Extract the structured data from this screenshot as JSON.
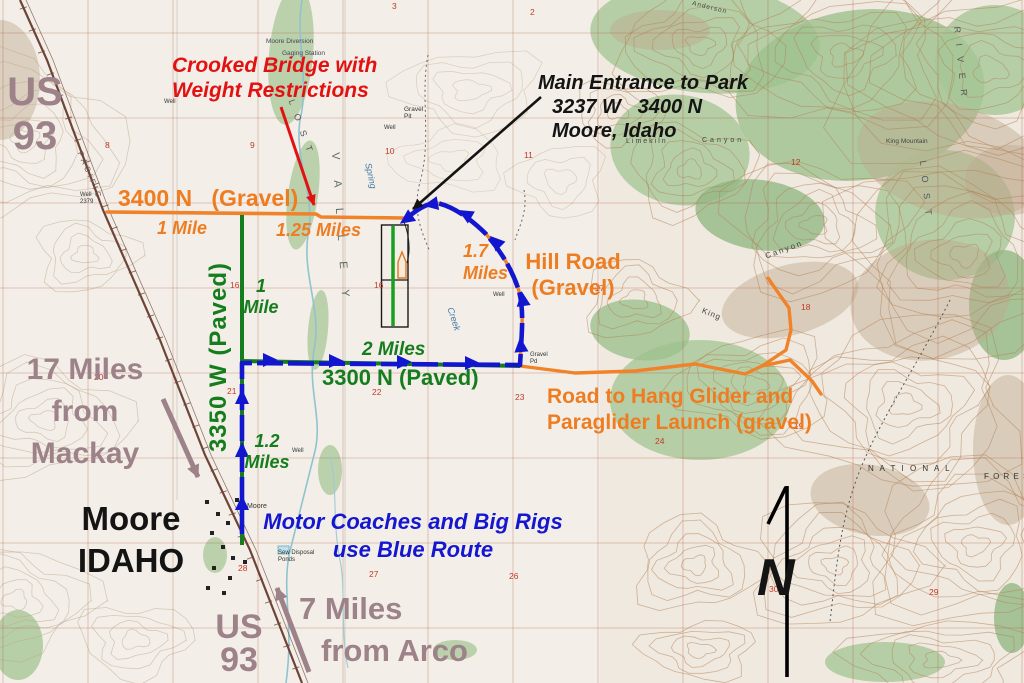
{
  "map": {
    "title": "Driving directions map to park near Moore, Idaho",
    "colors": {
      "road_gravel_orange": "#ee7d22",
      "road_paved_green": "#157d1d",
      "blue_route": "#1216cf",
      "warning_red": "#e31212",
      "distance_mauve": "#9d8289",
      "ink_black": "#141414"
    },
    "labels": {
      "us93_top": {
        "line1": "US",
        "line2": "93"
      },
      "crooked_bridge": {
        "text": "Crooked Bridge with\nWeight Restrictions"
      },
      "main_entrance": {
        "line1": "Main Entrance to Park",
        "line2": "3237 W   3400 N",
        "line3": "Moore, Idaho"
      },
      "road_3400n": {
        "text": "3400 N   (Gravel)"
      },
      "mile_1_orange": {
        "text": "1 Mile"
      },
      "miles_1_25": {
        "text": "1.25 Miles"
      },
      "miles_1_7": {
        "text": "1.7\nMiles"
      },
      "hill_road": {
        "text": "Hill Road\n(Gravel)"
      },
      "road_3350w": {
        "text": "3350 W (Paved)"
      },
      "mile_1_green": {
        "text": "1\nMile"
      },
      "miles_2": {
        "text": "2 Miles"
      },
      "road_3300n": {
        "text": "3300 N (Paved)"
      },
      "hang_glider_road": {
        "text": "Road to Hang Glider and\nParaglider Launch (gravel)"
      },
      "mackay": {
        "text": "17 Miles\nfrom\nMackay"
      },
      "moore_town": {
        "text": "Moore\nIDAHO"
      },
      "miles_1_2": {
        "text": "1.2\nMiles"
      },
      "motor_coaches": {
        "text": "Motor Coaches and Big Rigs\nuse Blue Route"
      },
      "us93_bottom": {
        "line1": "US",
        "line2": "93"
      },
      "arco": {
        "line1": "7 Miles",
        "line2": "from Arco"
      },
      "compass_n": {
        "text": "N"
      }
    },
    "landmarks": [
      {
        "text": "PACIFIC",
        "x": 84,
        "y": 150,
        "s": 8,
        "c": "#6b5a50",
        "r": 67,
        "ls": 3
      },
      {
        "text": "Moore Diversion",
        "x": 266,
        "y": 38,
        "s": 6.5,
        "c": "#445"
      },
      {
        "text": "Gaging Station",
        "x": 282,
        "y": 50,
        "s": 6.5,
        "c": "#445"
      },
      {
        "text": "V A L L E Y",
        "x": 341,
        "y": 152,
        "s": 11,
        "c": "#5c6b5c",
        "r": 86,
        "ls": 9
      },
      {
        "text": "Spring",
        "x": 373,
        "y": 162,
        "s": 9,
        "c": "#4179a3",
        "r": 78,
        "i": 1
      },
      {
        "text": "Creek",
        "x": 455,
        "y": 306,
        "s": 9,
        "c": "#4179a3",
        "r": 72,
        "i": 1
      },
      {
        "text": "L O S T",
        "x": 296,
        "y": 98,
        "s": 9,
        "c": "#555",
        "r": 70,
        "ls": 4
      },
      {
        "text": "Limekiln",
        "x": 626,
        "y": 138,
        "s": 7,
        "c": "#444",
        "ls": 2
      },
      {
        "text": "Canyon",
        "x": 702,
        "y": 137,
        "s": 7,
        "c": "#444",
        "ls": 3
      },
      {
        "text": "King",
        "x": 704,
        "y": 306,
        "s": 8,
        "c": "#444",
        "r": 22,
        "ls": 1
      },
      {
        "text": "Canyon",
        "x": 764,
        "y": 252,
        "s": 8,
        "c": "#444",
        "r": -20,
        "ls": 2
      },
      {
        "text": "King Mountain",
        "x": 886,
        "y": 138,
        "s": 6.5,
        "c": "#444"
      },
      {
        "text": "Anderson",
        "x": 693,
        "y": 0,
        "s": 6.5,
        "c": "#444",
        "r": 14,
        "ls": 1
      },
      {
        "text": "R I V E R",
        "x": 962,
        "y": 26,
        "s": 9,
        "c": "#555",
        "r": 84,
        "ls": 4
      },
      {
        "text": "L O S T",
        "x": 928,
        "y": 160,
        "s": 9,
        "c": "#555",
        "r": 84,
        "ls": 4
      },
      {
        "text": "N A T I O N A L",
        "x": 868,
        "y": 464,
        "s": 8,
        "c": "#333",
        "ls": 2
      },
      {
        "text": "F O R E S",
        "x": 984,
        "y": 472,
        "s": 8,
        "c": "#333",
        "ls": 1
      },
      {
        "text": "Moore",
        "x": 247,
        "y": 503,
        "s": 7,
        "c": "#333"
      },
      {
        "text": "Sew Disposal\nPonds",
        "x": 278,
        "y": 550,
        "s": 6,
        "c": "#333"
      },
      {
        "text": "Gravel\nPit",
        "x": 404,
        "y": 106,
        "s": 6.5,
        "c": "#333"
      },
      {
        "text": "Gravel\nPd",
        "x": 530,
        "y": 352,
        "s": 6,
        "c": "#333"
      },
      {
        "text": "Well",
        "x": 164,
        "y": 99,
        "s": 6,
        "c": "#333"
      },
      {
        "text": "Well",
        "x": 384,
        "y": 125,
        "s": 6,
        "c": "#333"
      },
      {
        "text": "Well",
        "x": 493,
        "y": 292,
        "s": 6,
        "c": "#333"
      },
      {
        "text": "Well",
        "x": 292,
        "y": 448,
        "s": 6,
        "c": "#333"
      },
      {
        "text": "Well\n2379",
        "x": 80,
        "y": 192,
        "s": 6,
        "c": "#333"
      },
      {
        "text": "8",
        "x": 105,
        "y": 141,
        "s": 8.5,
        "c": "#c0392b"
      },
      {
        "text": "9",
        "x": 250,
        "y": 141,
        "s": 8.5,
        "c": "#c0392b"
      },
      {
        "text": "10",
        "x": 385,
        "y": 147,
        "s": 8.5,
        "c": "#c0392b"
      },
      {
        "text": "11",
        "x": 524,
        "y": 151,
        "s": 8.5,
        "c": "#c0392b"
      },
      {
        "text": "12",
        "x": 791,
        "y": 158,
        "s": 8.5,
        "c": "#c0392b"
      },
      {
        "text": "16",
        "x": 230,
        "y": 281,
        "s": 8.5,
        "c": "#c0392b"
      },
      {
        "text": "16",
        "x": 374,
        "y": 281,
        "s": 8.5,
        "c": "#c0392b"
      },
      {
        "text": "17",
        "x": 595,
        "y": 284,
        "s": 8.5,
        "c": "#c0392b"
      },
      {
        "text": "18",
        "x": 801,
        "y": 303,
        "s": 8.5,
        "c": "#c0392b"
      },
      {
        "text": "20",
        "x": 94,
        "y": 373,
        "s": 8.5,
        "c": "#c0392b"
      },
      {
        "text": "21",
        "x": 227,
        "y": 387,
        "s": 8.5,
        "c": "#c0392b"
      },
      {
        "text": "22",
        "x": 372,
        "y": 388,
        "s": 8.5,
        "c": "#c0392b"
      },
      {
        "text": "23",
        "x": 515,
        "y": 393,
        "s": 8.5,
        "c": "#c0392b"
      },
      {
        "text": "24",
        "x": 655,
        "y": 437,
        "s": 8.5,
        "c": "#c0392b"
      },
      {
        "text": "19",
        "x": 794,
        "y": 422,
        "s": 8.5,
        "c": "#c0392b"
      },
      {
        "text": "27",
        "x": 369,
        "y": 570,
        "s": 8.5,
        "c": "#c0392b"
      },
      {
        "text": "28",
        "x": 238,
        "y": 564,
        "s": 8.5,
        "c": "#c0392b"
      },
      {
        "text": "26",
        "x": 509,
        "y": 572,
        "s": 8.5,
        "c": "#c0392b"
      },
      {
        "text": "30",
        "x": 769,
        "y": 585,
        "s": 8.5,
        "c": "#c0392b"
      },
      {
        "text": "29",
        "x": 929,
        "y": 588,
        "s": 8.5,
        "c": "#c0392b"
      },
      {
        "text": "2",
        "x": 530,
        "y": 8,
        "s": 8.5,
        "c": "#c0392b"
      },
      {
        "text": "3",
        "x": 392,
        "y": 2,
        "s": 8.5,
        "c": "#c0392b"
      }
    ]
  }
}
